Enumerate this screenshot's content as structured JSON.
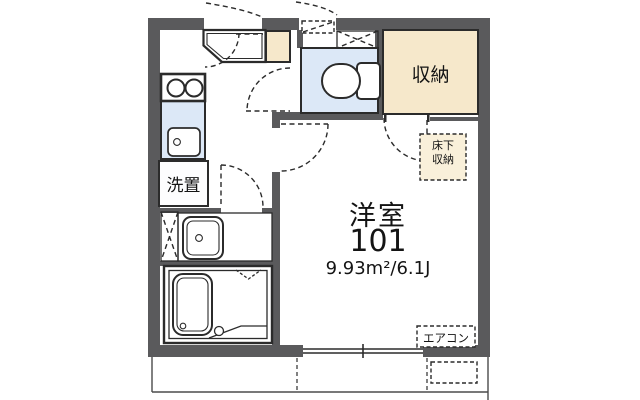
{
  "floor_plan": {
    "title": "apartment-room-101-floor-plan",
    "rooms": {
      "main_room": {
        "name": "洋室",
        "number": "101",
        "area": "9.93m²/6.1J"
      },
      "closet": {
        "label": "収納"
      },
      "underfloor_storage": {
        "label_line1": "床下",
        "label_line2": "収納"
      },
      "washer_space": {
        "label": "洗置"
      },
      "aircon": {
        "label": "エアコン"
      }
    },
    "colors": {
      "wall": "#5a5a5c",
      "line": "#2b2b2b",
      "room_blue": "#dce8f7",
      "closet_beige": "#f6e8cb",
      "underfloor_beige": "#f9f0da",
      "background": "#ffffff",
      "text": "#141414"
    }
  }
}
